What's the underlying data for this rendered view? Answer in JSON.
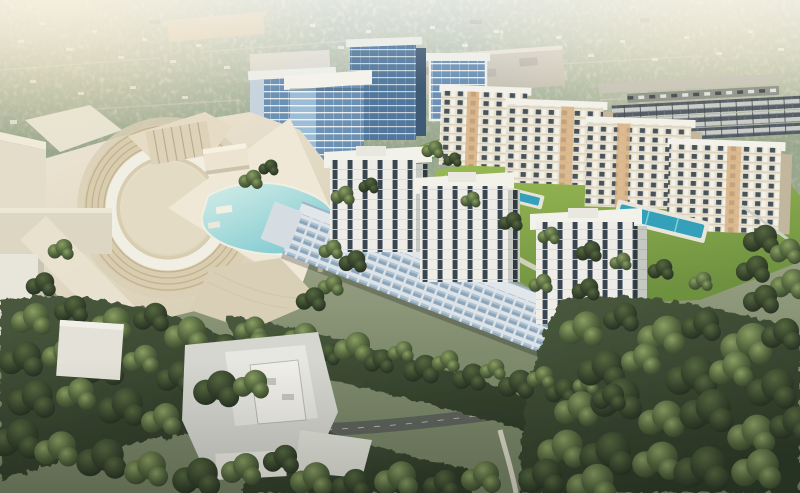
{
  "description": "Aerial architectural rendering of a mixed-use master-planned development: blue glass office towers, four cream apartment blocks with lawns and swimming pools, a terraced crescent amphitheater wrapping a turquoise lagoon, a long retail podium topped by three white residential towers, flat-roofed mall buildings, tree-lined roads and dense surrounding forest under warm hazy light.",
  "scene_summary": "Sunlit aerial view of a new urban district surrounded by low-rise suburbs and mature trees.",
  "regions": [
    {
      "name": "background-suburbs",
      "label": "Hazy low-rise suburban sprawl with trees"
    },
    {
      "name": "office-towers",
      "label": "Blue glass office tower cluster"
    },
    {
      "name": "apartment-row",
      "label": "Four cream apartment blocks with pools"
    },
    {
      "name": "amphitheater-crescent",
      "label": "Terraced crescent amphitheater and plaza"
    },
    {
      "name": "lagoon-pool",
      "label": "Turquoise lagoon water feature"
    },
    {
      "name": "central-podium",
      "label": "Retail podium with three white residential towers"
    },
    {
      "name": "mall-buildings",
      "label": "Flat-roofed white mall / big-box buildings"
    },
    {
      "name": "forest",
      "label": "Dense tree cover and landscaped greens"
    },
    {
      "name": "roads",
      "label": "Access roads, junction and crosswalks"
    }
  ],
  "palette": {
    "sky1": "#ece6d4",
    "sky2": "#d5d3bf",
    "sky3": "#a9ae93",
    "sky4": "#7f8b6d",
    "glowWarm": "#f0ddae",
    "veil": "#f6f1e2",
    "treeHi": "#8a9e63",
    "treeMid": "#55683f",
    "treeDark": "#36432c",
    "treeDeep": "#242e20",
    "forest1": "#4a5a3e",
    "forest2": "#2c3826",
    "lawn1": "#9cbb55",
    "lawn2": "#6e9140",
    "island": "#6f8747",
    "canalBank": "#7b9a52",
    "water1": "#d5eee8",
    "water2": "#7cc8cf",
    "pool": "#35a0ba",
    "glass": "#6d91b5",
    "glassD": "#51789c",
    "glassL": "#9dbdd6",
    "frame": "#e7ecef",
    "glassSide": "#3f5a74",
    "cream": "#e8e1cf",
    "creamSh": "#c2b79e",
    "tan": "#d8b184",
    "winD": "#46525c",
    "roofWhite": "#f3f2ea",
    "towerWall": "#eeede7",
    "towerWin": "#39454f",
    "towerSide": "#c6c8c2",
    "towerSideWin": "#2f3a42",
    "podBase": "#dde4e9",
    "podWin": "#8ea6ba",
    "podWinLite": "#b8cad8",
    "podRoof": "#e0e6ea",
    "podEdge": "#9db3c4",
    "plaza1": "#efe8d7",
    "plaza2": "#d9cfb6",
    "steps": "#bfae8c",
    "terr": "#d9cdb0",
    "stage": "#e4dbc4",
    "ringWhite": "#f1eee3",
    "whiteBldg": "#d6d6d0",
    "whiteBldg2": "#e7e7e1",
    "whiteBldg3": "#f0efe9",
    "road": "#5d625c",
    "roadLine": "#cfd2c8",
    "pathLight": "#d9d6c6",
    "wallLight": "#ccd0c6",
    "townRoof": "#525b64",
    "townWall": "#c9ccc9",
    "parking": "#8f948d",
    "roofWarm": "#c8b694",
    "boxRoof": "#b7b2a2",
    "houseLite": "#dfdcd2",
    "houseDark": "#8b887c"
  }
}
